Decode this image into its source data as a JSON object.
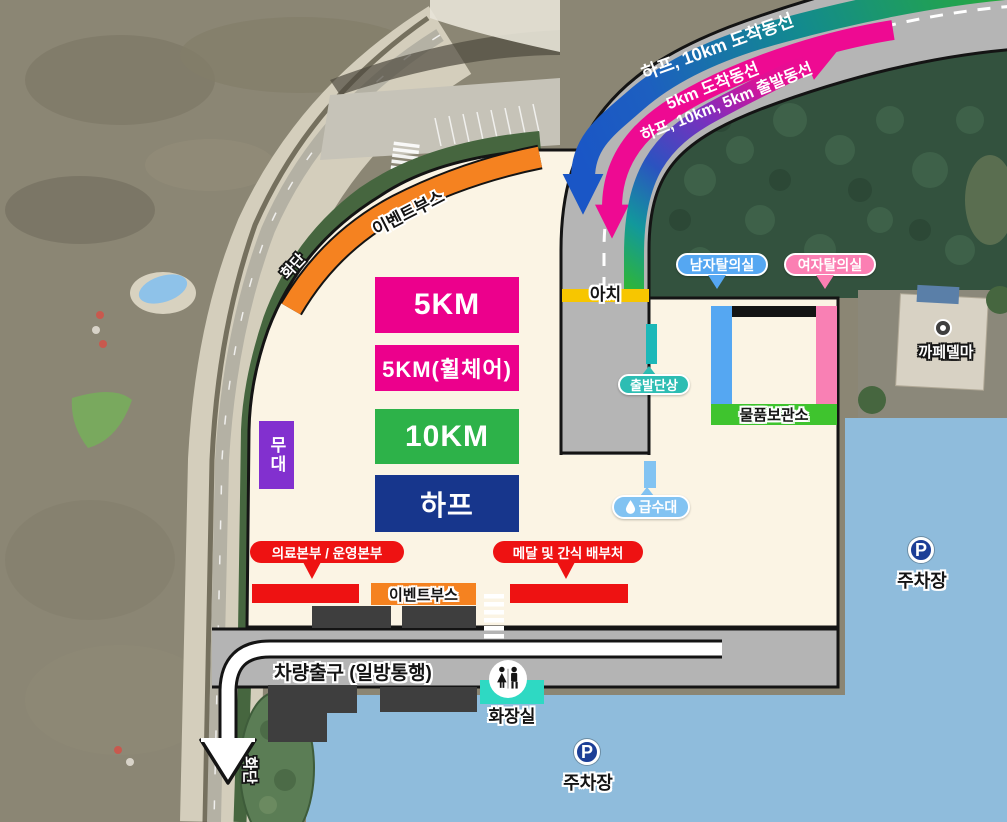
{
  "legend": {
    "route_arrival_half_10km": "하프, 10km 도착동선",
    "route_arrival_5km": "5km 도착동선",
    "route_departure_all": "하프, 10km, 5km 출발동선"
  },
  "zones": {
    "km5": "5KM",
    "km5_wheelchair": "5KM(휠체어)",
    "km10": "10KM",
    "half": "하프",
    "stage": "무대"
  },
  "facilities": {
    "event_booth_top": "이벤트부스",
    "flowerbed_top": "화단",
    "flowerbed_bottom": "화단",
    "arch": "아치",
    "start_podium": "출발단상",
    "mens_changing_room": "남자탈의실",
    "womens_changing_room": "여자탈의실",
    "storage": "물품보관소",
    "cafe": "까페델마",
    "water_station": "급수대",
    "medical_ops_hq": "의료본부 / 운영본부",
    "medal_snack_station": "메달 및 간식 배부처",
    "event_booth_bottom": "이벤트부스",
    "vehicle_exit": "차량출구 (일방통행)",
    "restroom": "화장실",
    "parking_east": "주차장",
    "parking_south": "주차장",
    "parking_symbol": "P"
  },
  "colors": {
    "venue_cream": "#fbf4e4",
    "road_gray": "#b5b5b5",
    "parking_blue": "#8fbcdc",
    "zone_magenta": "#ec008c",
    "zone_green": "#2db249",
    "zone_navy": "#17368c",
    "stage_purple": "#8230cf",
    "booth_orange": "#f58220",
    "alert_red": "#ee1212",
    "arch_yellow": "#f7c600",
    "podium_teal": "#2dbdb3",
    "water_blue": "#82c3f2",
    "bar_blue": "#55a7f2",
    "bar_pink": "#f980b4",
    "storage_green": "#3fc42e",
    "arrow_blue": "#1a56c6",
    "arrow_magenta": "#ee0a92",
    "arrow_green": "#29b03b",
    "toilet_teal": "#2ed9c3"
  }
}
